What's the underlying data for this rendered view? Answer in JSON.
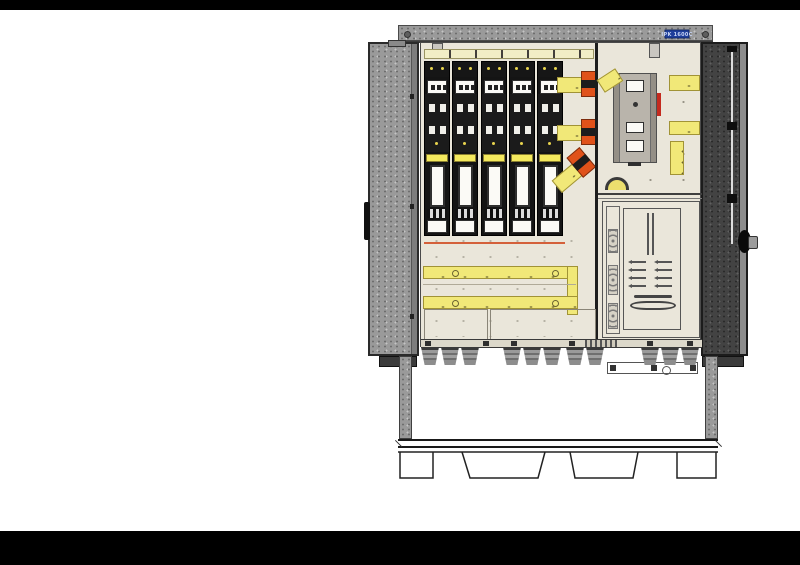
{
  "cabinet": {
    "nameplate": {
      "text": "IPK 1600C",
      "bg": "#1e3e9b",
      "fg": "#c7d4f4"
    },
    "fuse_switch_count": 5,
    "clamp_count": 3,
    "cable_gland_groups": [
      3,
      3,
      2,
      3
    ],
    "terminal_strip_count": 3,
    "meter_window_count": 3,
    "dash_row_count": 4,
    "colors": {
      "busbar_yellow": "#f1e878",
      "clamp_orange": "#e0521a",
      "interior_cream": "#eae6da",
      "door_left_gray": "#9a9a9a",
      "door_right_dark": "#434343",
      "alert_red": "#c42a1e"
    }
  }
}
